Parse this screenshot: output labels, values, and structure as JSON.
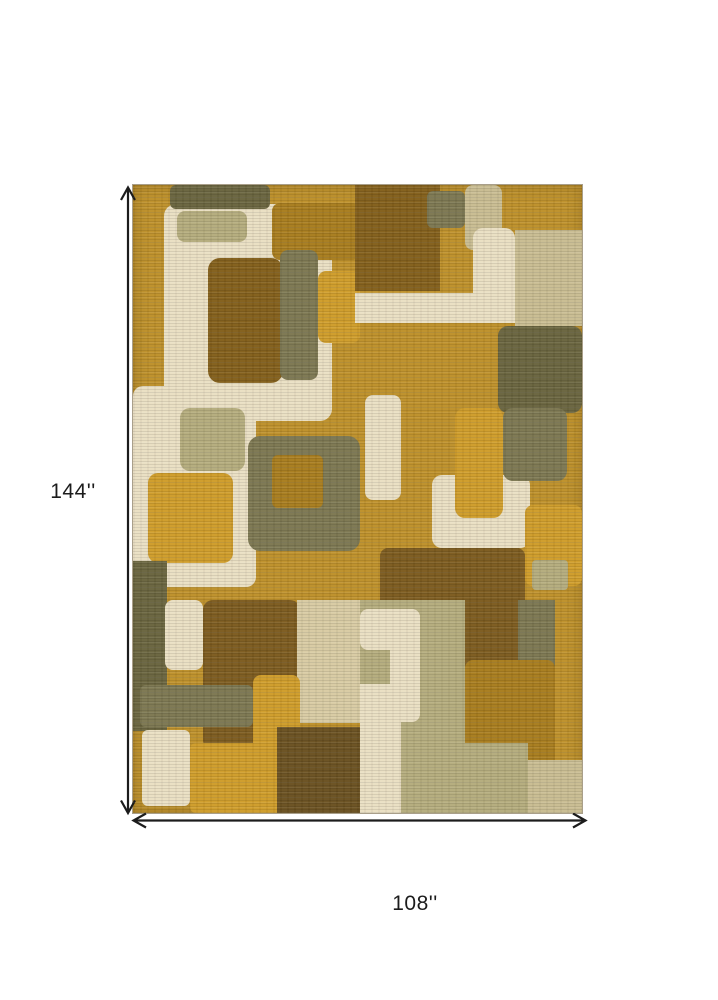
{
  "figure": {
    "type": "product-dimension-diagram",
    "subject": "abstract geometric patchwork area rug",
    "height_label": "144''",
    "width_label": "108''",
    "line_color": "#1c1c1c",
    "background": "#ffffff"
  },
  "rug": {
    "base_color": "#be912b",
    "palette": {
      "gold": "#be912b",
      "goldBright": "#cf9d2b",
      "goldenrod": "#a87d1f",
      "bronze": "#84601c",
      "brown": "#7d5c20",
      "darkBrown": "#6b5222",
      "oliveDark": "#6a653f",
      "olive": "#7d7852",
      "sage": "#b5ac7d",
      "tan": "#c9bd92",
      "tanLight": "#d8cba3",
      "cream": "#eadfc3"
    },
    "blocks": [
      {
        "x": 6.8,
        "y": 3.0,
        "w": 37.5,
        "h": 34.6,
        "color": "cream",
        "radius": 12
      },
      {
        "x": 8.2,
        "y": 0,
        "w": 22.3,
        "h": 3.8,
        "color": "oliveDark",
        "radius": 6
      },
      {
        "x": 9.8,
        "y": 4.1,
        "w": 15.6,
        "h": 4.9,
        "color": "sage",
        "radius": 8
      },
      {
        "x": 31.0,
        "y": 2.9,
        "w": 19.6,
        "h": 9.0,
        "color": "goldenrod",
        "radius": 8
      },
      {
        "x": 16.7,
        "y": 11.6,
        "w": 16.7,
        "h": 19.9,
        "color": "bronze",
        "radius": 12
      },
      {
        "x": 32.7,
        "y": 10.4,
        "w": 8.5,
        "h": 20.7,
        "color": "olive",
        "radius": 8
      },
      {
        "x": 41.2,
        "y": 13.7,
        "w": 9.4,
        "h": 11.5,
        "color": "goldBright",
        "radius": 8
      },
      {
        "x": 49.4,
        "y": 0,
        "w": 19.0,
        "h": 16.9,
        "color": "bronze",
        "radius": 0
      },
      {
        "x": 65.5,
        "y": 1.0,
        "w": 8.4,
        "h": 5.8,
        "color": "olive",
        "radius": 6
      },
      {
        "x": 73.9,
        "y": 0,
        "w": 8.3,
        "h": 10.4,
        "color": "tan",
        "radius": 8
      },
      {
        "x": 85.1,
        "y": 7.2,
        "w": 14.9,
        "h": 15.3,
        "color": "tan",
        "radius": 0
      },
      {
        "x": 75.7,
        "y": 6.8,
        "w": 9.4,
        "h": 15.2,
        "color": "cream",
        "radius": 10
      },
      {
        "x": 49.4,
        "y": 17.2,
        "w": 35.7,
        "h": 4.8,
        "color": "cream",
        "radius": 0
      },
      {
        "x": 81.3,
        "y": 22.4,
        "w": 18.7,
        "h": 13.9,
        "color": "oliveDark",
        "radius": 10
      },
      {
        "x": 0,
        "y": 32.0,
        "w": 27.5,
        "h": 32.0,
        "color": "cream",
        "radius": 10
      },
      {
        "x": 10.5,
        "y": 35.5,
        "w": 14.4,
        "h": 10.0,
        "color": "sage",
        "radius": 10
      },
      {
        "x": 3.3,
        "y": 45.8,
        "w": 19.0,
        "h": 14.4,
        "color": "goldBright",
        "radius": 10
      },
      {
        "x": 25.6,
        "y": 40.0,
        "w": 25.0,
        "h": 18.3,
        "color": "olive",
        "radius": 12
      },
      {
        "x": 31.0,
        "y": 43.0,
        "w": 11.3,
        "h": 8.4,
        "color": "goldenrod",
        "radius": 6
      },
      {
        "x": 51.7,
        "y": 33.4,
        "w": 8.0,
        "h": 16.8,
        "color": "cream",
        "radius": 8
      },
      {
        "x": 66.6,
        "y": 46.2,
        "w": 21.8,
        "h": 11.6,
        "color": "cream",
        "radius": 10
      },
      {
        "x": 71.7,
        "y": 35.5,
        "w": 10.7,
        "h": 17.5,
        "color": "goldBright",
        "radius": 10
      },
      {
        "x": 82.4,
        "y": 35.5,
        "w": 14.2,
        "h": 11.6,
        "color": "olive",
        "radius": 10
      },
      {
        "x": 55.0,
        "y": 57.8,
        "w": 32.3,
        "h": 14.3,
        "color": "brown",
        "radius": 8
      },
      {
        "x": 87.3,
        "y": 51.0,
        "w": 12.7,
        "h": 12.8,
        "color": "goldBright",
        "radius": 8
      },
      {
        "x": 88.9,
        "y": 59.7,
        "w": 8.0,
        "h": 4.8,
        "color": "sage",
        "radius": 4
      },
      {
        "x": 0,
        "y": 59.9,
        "w": 7.6,
        "h": 27.0,
        "color": "oliveDark",
        "radius": 0
      },
      {
        "x": 7.1,
        "y": 66.1,
        "w": 8.5,
        "h": 11.1,
        "color": "cream",
        "radius": 8
      },
      {
        "x": 15.6,
        "y": 66.1,
        "w": 21.6,
        "h": 23.9,
        "color": "brown",
        "radius": 10
      },
      {
        "x": 1.6,
        "y": 79.6,
        "w": 25.1,
        "h": 6.7,
        "color": "olive",
        "radius": 6
      },
      {
        "x": 2.0,
        "y": 86.8,
        "w": 10.7,
        "h": 12.1,
        "color": "cream",
        "radius": 6
      },
      {
        "x": 36.5,
        "y": 66.1,
        "w": 14.1,
        "h": 19.6,
        "color": "tanLight",
        "radius": 0
      },
      {
        "x": 26.7,
        "y": 78.0,
        "w": 10.5,
        "h": 22.0,
        "color": "goldBright",
        "radius": 8
      },
      {
        "x": 12.7,
        "y": 88.8,
        "w": 19.3,
        "h": 11.2,
        "color": "goldBright",
        "radius": 6
      },
      {
        "x": 32.0,
        "y": 86.3,
        "w": 18.6,
        "h": 13.7,
        "color": "darkBrown",
        "radius": 0
      },
      {
        "x": 50.6,
        "y": 66.1,
        "w": 23.4,
        "h": 33.9,
        "color": "sage",
        "radius": 0
      },
      {
        "x": 50.6,
        "y": 67.5,
        "w": 13.4,
        "h": 6.5,
        "color": "cream",
        "radius": 8
      },
      {
        "x": 57.2,
        "y": 67.5,
        "w": 6.8,
        "h": 18.0,
        "color": "cream",
        "radius": 8
      },
      {
        "x": 50.6,
        "y": 79.5,
        "w": 9.0,
        "h": 20.5,
        "color": "cream",
        "radius": 0
      },
      {
        "x": 73.9,
        "y": 66.1,
        "w": 11.8,
        "h": 17.5,
        "color": "brown",
        "radius": 0
      },
      {
        "x": 85.7,
        "y": 66.1,
        "w": 8.3,
        "h": 17.5,
        "color": "olive",
        "radius": 0
      },
      {
        "x": 74.0,
        "y": 75.6,
        "w": 20.0,
        "h": 20.2,
        "color": "goldenrod",
        "radius": 8
      },
      {
        "x": 71.7,
        "y": 88.8,
        "w": 16.3,
        "h": 11.2,
        "color": "sage",
        "radius": 0
      },
      {
        "x": 88.0,
        "y": 91.5,
        "w": 12.0,
        "h": 8.5,
        "color": "tan",
        "radius": 0
      }
    ]
  }
}
